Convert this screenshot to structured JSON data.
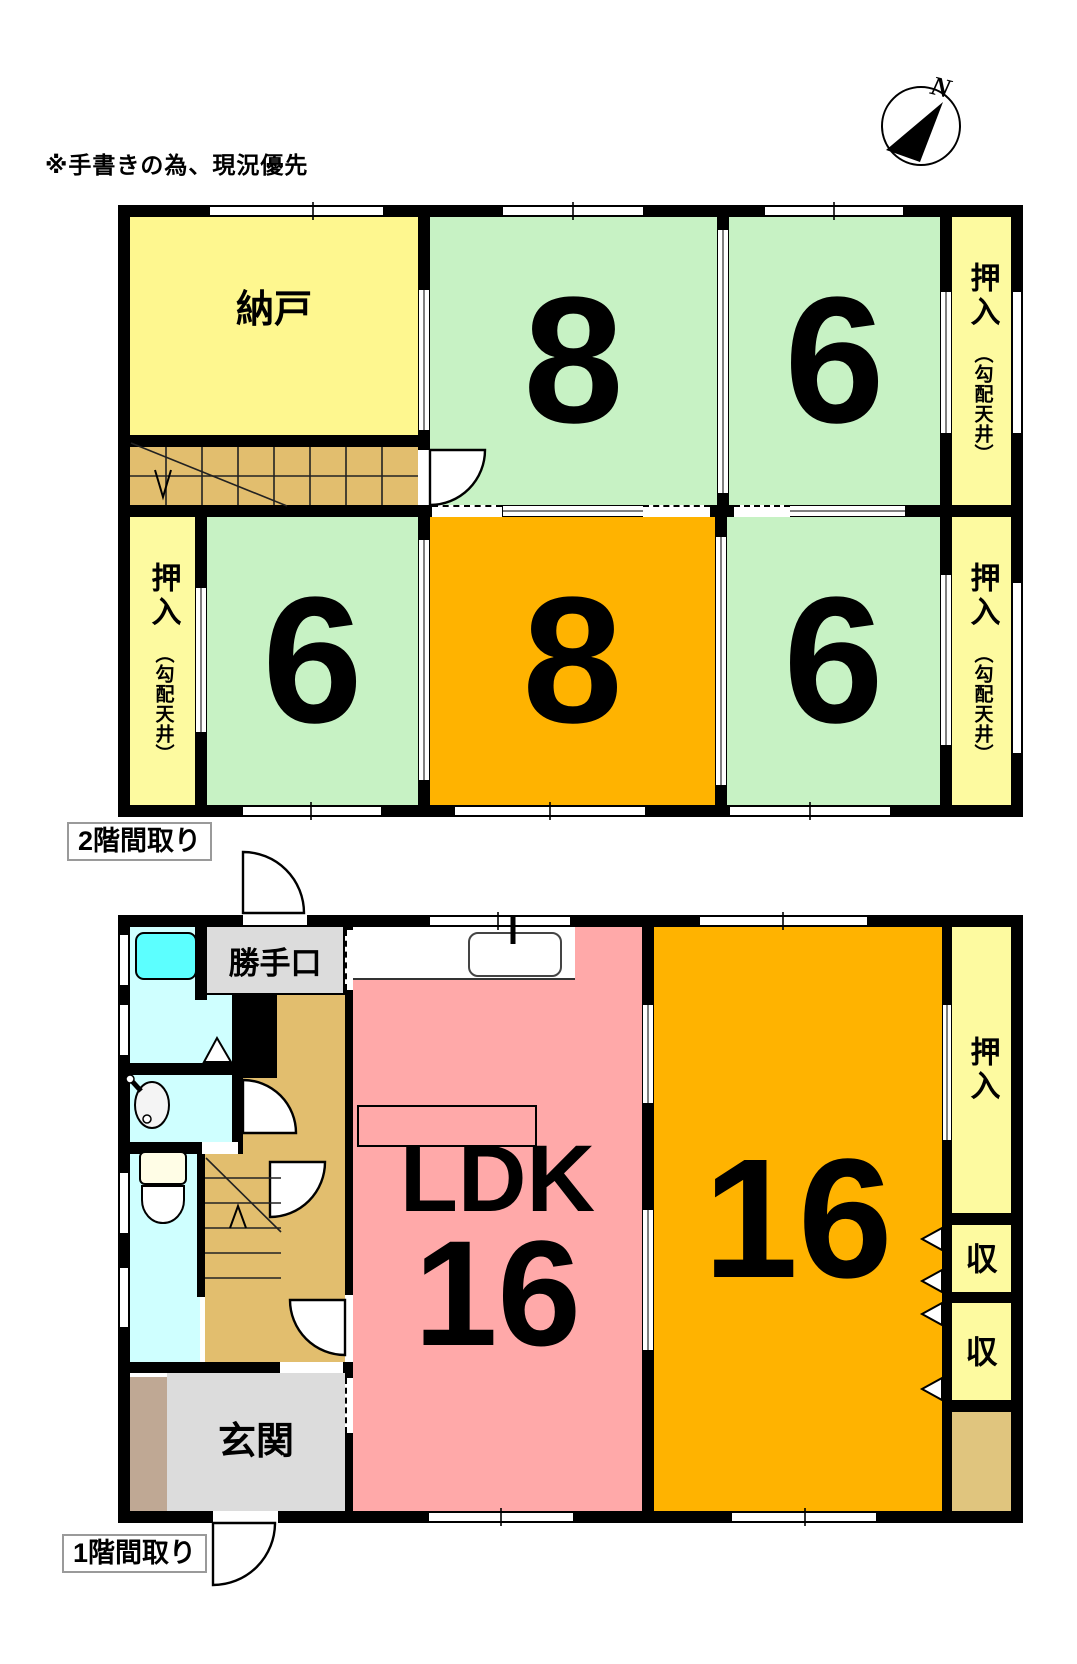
{
  "note": "※手書きの為、現況優先",
  "compass": {
    "north": "N"
  },
  "floor2": {
    "caption": "2階間取り",
    "rooms": {
      "nando": {
        "name": "納戸"
      },
      "room8_top": {
        "tatami": "8"
      },
      "room6_top": {
        "tatami": "6"
      },
      "room6_bottom_left": {
        "tatami": "6"
      },
      "room8_bottom": {
        "tatami": "8"
      },
      "room6_bottom_right": {
        "tatami": "6"
      },
      "closet_top_right": {
        "name": "押入",
        "ceiling_note": "（勾配天井）"
      },
      "closet_left": {
        "name": "押入",
        "ceiling_note": "（勾配天井）"
      },
      "closet_bottom_right": {
        "name": "押入",
        "ceiling_note": "（勾配天井）"
      }
    }
  },
  "floor1": {
    "caption": "1階間取り",
    "rooms": {
      "katteguchi": {
        "name": "勝手口"
      },
      "ldk": {
        "name": "LDK",
        "tatami": "16"
      },
      "washitsu16": {
        "tatami": "16"
      },
      "genkan": {
        "name": "玄関"
      },
      "oshiire": {
        "name": "押入"
      },
      "storage_upper": {
        "name": "収"
      },
      "storage_lower": {
        "name": "収"
      }
    }
  },
  "palette": {
    "wall": "#000000",
    "room_green": "#C7F2C4",
    "room_orange": "#FFB300",
    "room_yellow": "#FEF78F",
    "closet_yellow": "#FDFAA0",
    "ldk_pink": "#FFA9A9",
    "hall_tan": "#E2BE6E",
    "bath_cyan": "#CFFFFF",
    "tub_cyan": "#5CFFFF",
    "entry_gray": "#DCDCDC",
    "cabinet_brown": "#BFA894",
    "closet_tan": "#E0C57E"
  }
}
